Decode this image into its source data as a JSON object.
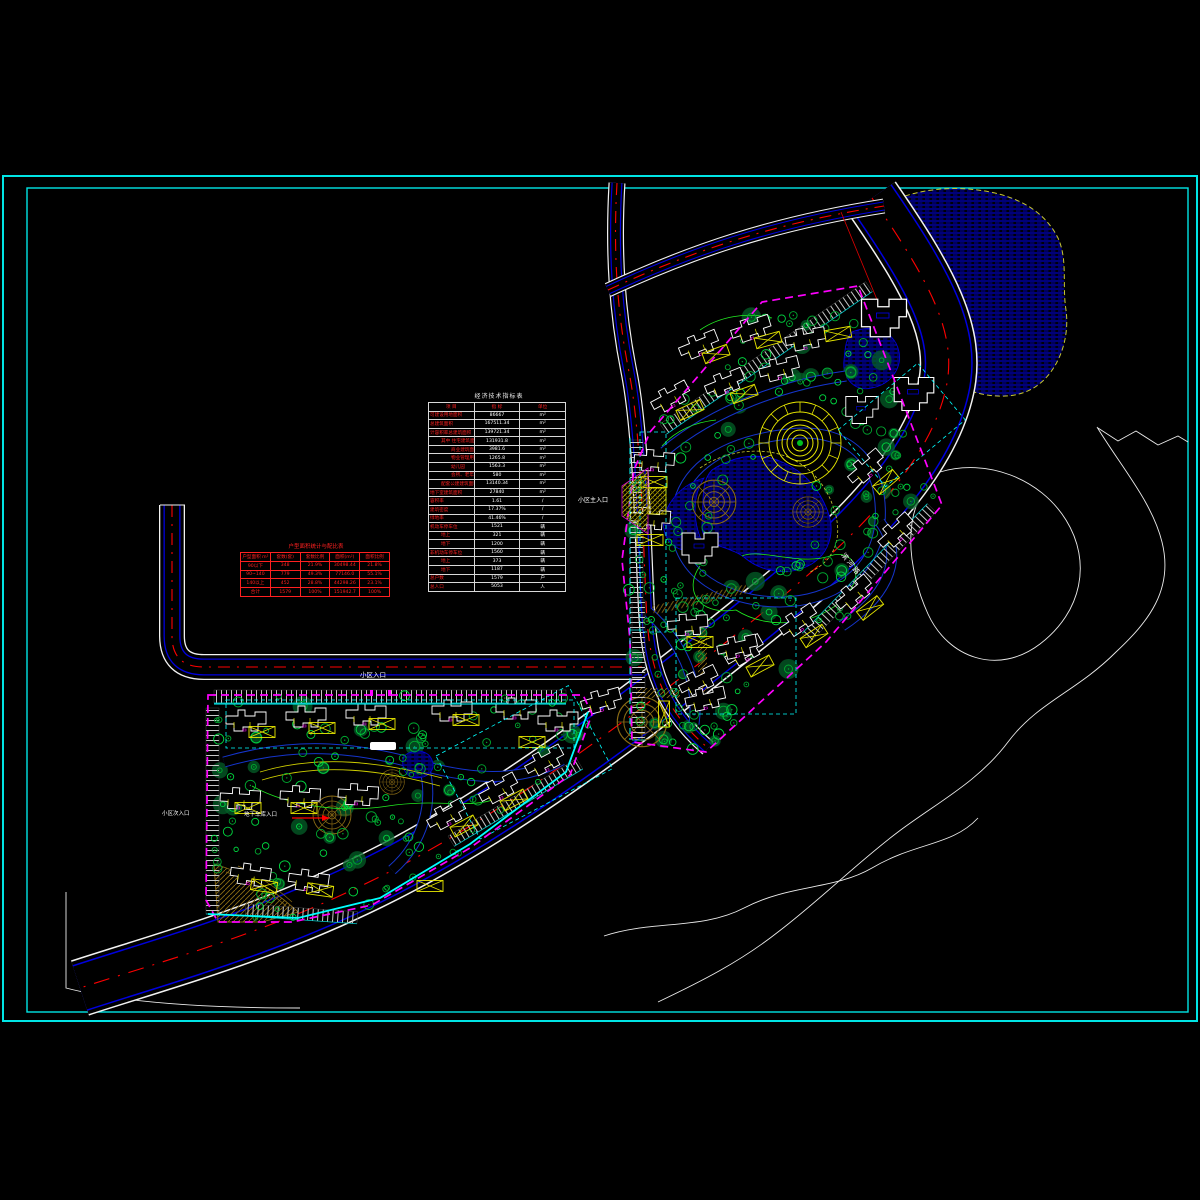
{
  "drawing": {
    "type_label": "residential-master-plan-cad-drawing"
  },
  "colors": {
    "background": "#000000",
    "frame_cyan": "#00e5e5",
    "site_boundary_magenta": "#ff00ff",
    "road_edge_white": "#f2f2f2",
    "road_curb_blue": "#0000dd",
    "centerline_red": "#ff0000",
    "water_blue": "#0000cc",
    "water_outline_yellow": "#c8c830",
    "tree_green": "#00a830",
    "canopy_dark_green": "#045f28",
    "plaza_brown": "#8a6b15",
    "annotation_yellow": "#e6e600",
    "building_white": "#ffffff",
    "inner_boundary_cyan": "#00ffff",
    "table_red": "#ff2020"
  },
  "tables": {
    "indicators": {
      "title": "经济技术指标表",
      "headers": [
        "项  目",
        "指 标",
        "单位"
      ],
      "rows": [
        {
          "label": "可建设用地面积",
          "value": "86667",
          "unit": "m²",
          "indent": 0
        },
        {
          "label": "总建筑面积",
          "value": "167511.34",
          "unit": "m²",
          "indent": 0
        },
        {
          "label": "计容积率总建筑面积",
          "value": "139721.34",
          "unit": "m²",
          "indent": 0
        },
        {
          "label": "其中 住宅建筑面积",
          "value": "131931.8",
          "unit": "m²",
          "indent": 1
        },
        {
          "label": "商业建筑面积",
          "value": "3981.6",
          "unit": "m²",
          "indent": 2
        },
        {
          "label": "物业管理用房",
          "value": "1265.8",
          "unit": "m²",
          "indent": 2
        },
        {
          "label": "幼儿园",
          "value": "1563.3",
          "unit": "m²",
          "indent": 2
        },
        {
          "label": "会所、老年活动用房",
          "value": "580",
          "unit": "m²",
          "indent": 2
        },
        {
          "label": "配套公建建筑面积",
          "value": "13140.34",
          "unit": "m²",
          "indent": 1
        },
        {
          "label": "地下室建筑面积",
          "value": "27840",
          "unit": "m²",
          "indent": 0
        },
        {
          "label": "容积率",
          "value": "1.61",
          "unit": "/",
          "indent": 0
        },
        {
          "label": "建筑密度",
          "value": "17.37%",
          "unit": "/",
          "indent": 0
        },
        {
          "label": "绿地率",
          "value": "41.46%",
          "unit": "/",
          "indent": 0
        },
        {
          "label": "机动车停车位",
          "value": "1521",
          "unit": "辆",
          "indent": 0
        },
        {
          "label": "地上",
          "value": "321",
          "unit": "辆",
          "indent": 1
        },
        {
          "label": "地下",
          "value": "1200",
          "unit": "辆",
          "indent": 1
        },
        {
          "label": "非机动车停车位",
          "value": "1560",
          "unit": "辆",
          "indent": 0
        },
        {
          "label": "地上",
          "value": "373",
          "unit": "辆",
          "indent": 1
        },
        {
          "label": "地下",
          "value": "1187",
          "unit": "辆",
          "indent": 1
        },
        {
          "label": "总户数",
          "value": "1579",
          "unit": "户",
          "indent": 0
        },
        {
          "label": "总人口",
          "value": "5053",
          "unit": "人",
          "indent": 0
        }
      ]
    },
    "unit_mix": {
      "title": "户型面积统计与配比表",
      "headers": [
        "户型面积 m²",
        "套数(套)",
        "套数比例",
        "面积(m²)",
        "面积比例"
      ],
      "rows": [
        [
          "90以下",
          "348",
          "21.9%",
          "30498.44",
          "21.8%"
        ],
        [
          "90~140",
          "779",
          "49.3%",
          "77146.0",
          "55.1%"
        ],
        [
          "140以上",
          "452",
          "28.8%",
          "44298.26",
          "23.1%"
        ],
        [
          "合计",
          "1579",
          "100%",
          "151942.7",
          "100%"
        ]
      ]
    }
  },
  "labels": {
    "entrance_side": "小区入口",
    "entrance_main": "小区主入口",
    "entrance_secondary": "小区次入口",
    "garage_entrance": "地下车库入口",
    "road_name": "滨河路"
  }
}
